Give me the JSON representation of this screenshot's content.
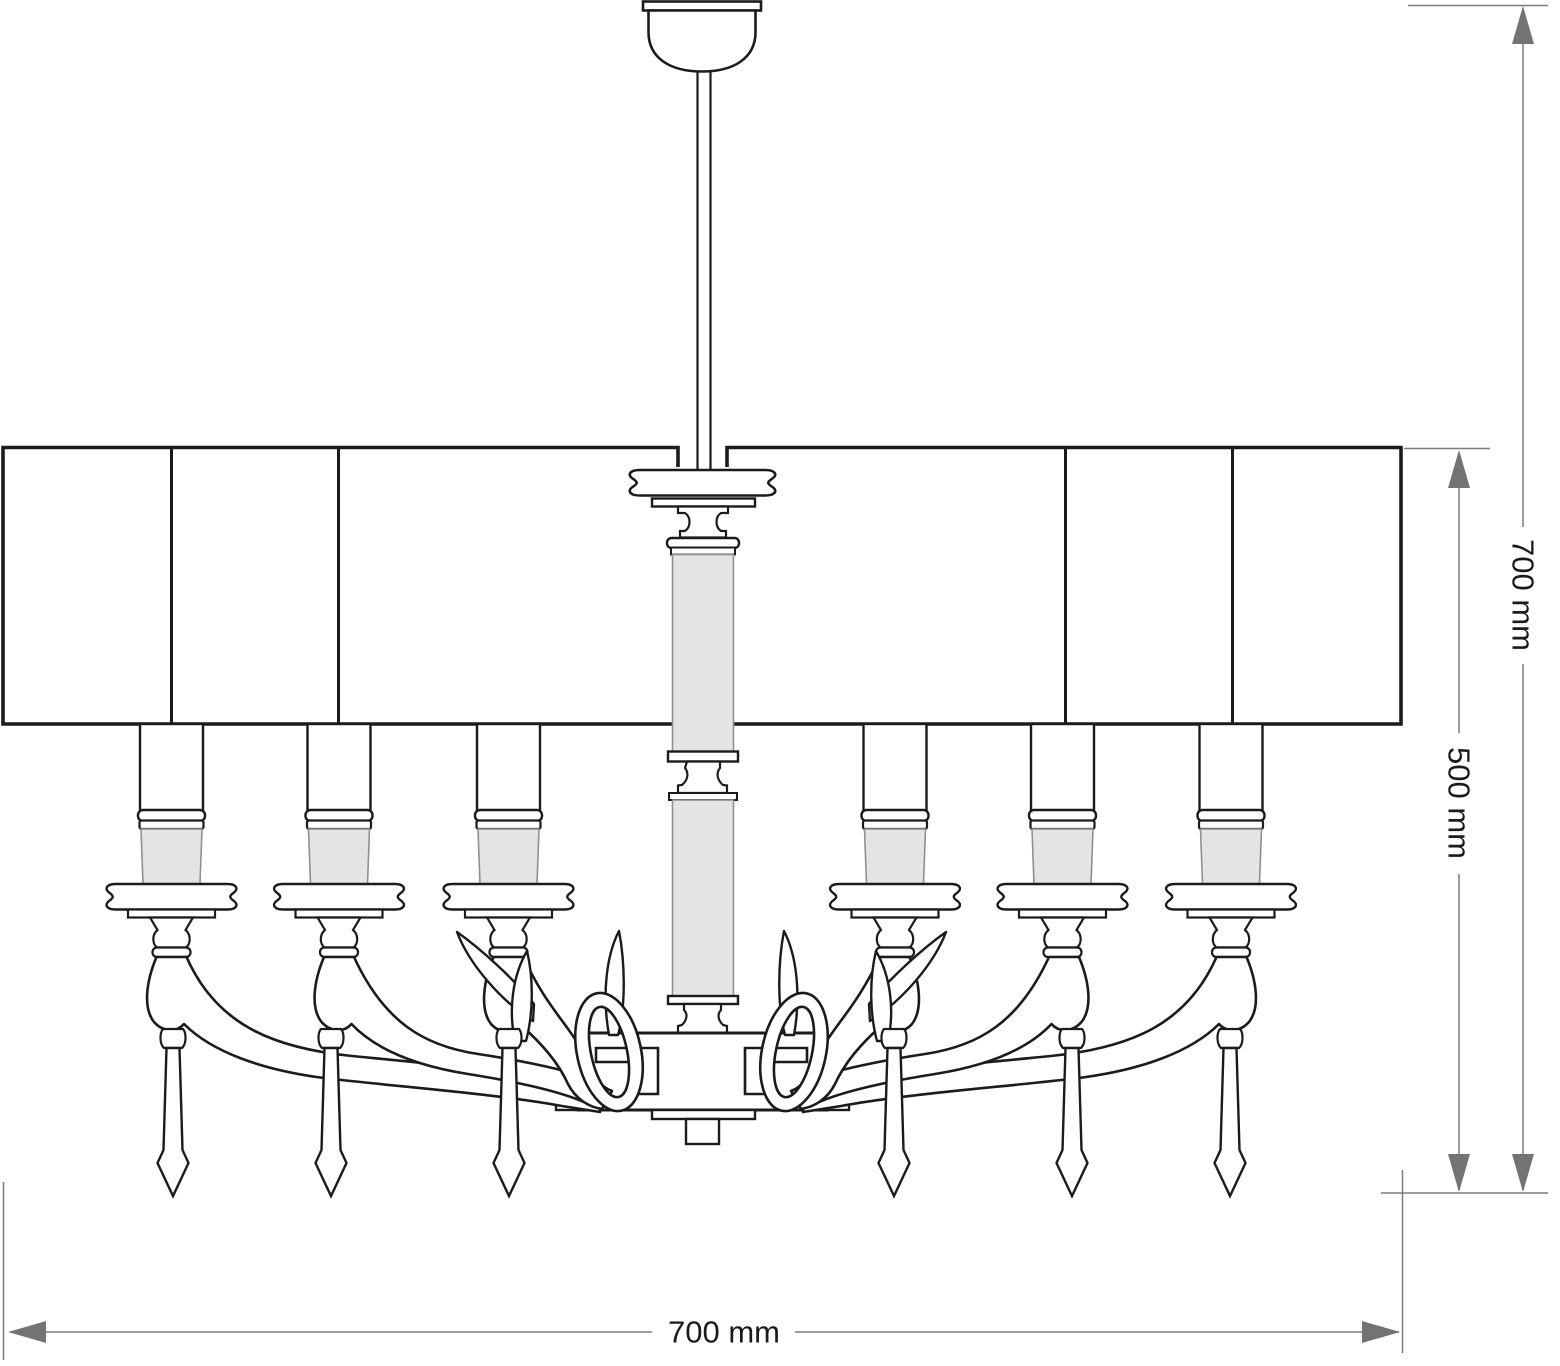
{
  "drawing": {
    "subject": "six-arm chandelier with drum shade and crystal pendants, front elevation technical drawing",
    "line_color": "#1b1b1b",
    "dimension_color": "#7b7b7b",
    "arrow_color": "#737373",
    "candle_sleeve_fill": "#e4e4e6",
    "background": "#ffffff",
    "arm_count": 6,
    "candle_count": 6,
    "pendant_count": 6,
    "shade_panel_count": 5
  },
  "dimensions": {
    "overall_height": {
      "label": "700 mm"
    },
    "body_height": {
      "label": "500 mm"
    },
    "shade_width": {
      "label": "700 mm"
    }
  }
}
